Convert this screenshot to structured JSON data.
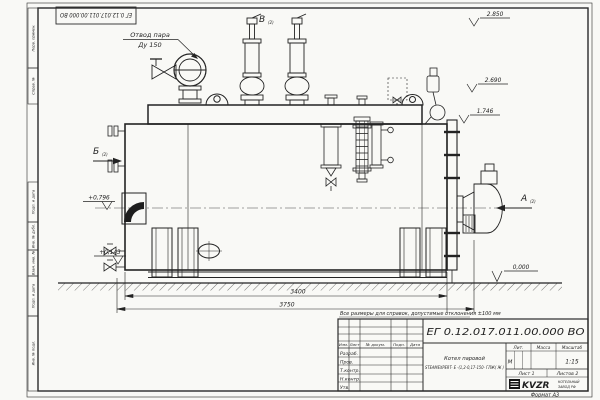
{
  "sheet": {
    "doc_number": "ЕГ 0.12.017.011.00.000  ВО",
    "format_note": "Формат А3",
    "tolerance_note": "Все размеры для справок, допустимые отклонения ±100 мм"
  },
  "frame_strip": {
    "labels": [
      "Перв. примен.",
      "Справ. №",
      "Подп. и дата",
      "Инв. № дубл.",
      "Взам. инв. №",
      "Подп. и дата",
      "Инв. № подл."
    ]
  },
  "views": {
    "top": "В",
    "left": "Б",
    "right": "А",
    "ref": "(2)"
  },
  "labels": {
    "steam_outlet_1": "Отвод пара",
    "steam_outlet_2": "Ду 150"
  },
  "elevations": {
    "e2850": "2.850",
    "e2690": "2.690",
    "e1746": "1.746",
    "e0796": "+0,796",
    "e0143": "+0,143",
    "e0000": "0,000"
  },
  "dimensions": {
    "shell_length": "3400",
    "overall_length": "3750"
  },
  "title_block": {
    "doc_number": "ЕГ 0.12.017.011.00.000  ВО",
    "name_line1": "Котел паровой",
    "name_line2": "STEAMEXPERT- Е -(1,2-0,17-150- ГЛЖ( Ж )",
    "col_izm": "Изм.",
    "col_list": "Лист",
    "col_doc": "№ докум.",
    "col_sign": "Подп.",
    "col_date": "Дата",
    "row_razrab": "Разраб.",
    "row_prov": "Пров.",
    "row_tkontr": "Т.контр.",
    "row_nkontr": "Н.контр.",
    "row_utv": "Утв.",
    "lit_label": "Лит.",
    "mass_label": "Масса",
    "scale_label": "Масштаб",
    "lit_value": "М",
    "scale_value": "1:15",
    "sheet_info": "Лист 1",
    "sheets_info": "Листов 2",
    "logo_text": "KVZR",
    "company_line1": "КОТЕЛЬНЫЙ",
    "company_line2": "ЗАВОД РФ"
  }
}
